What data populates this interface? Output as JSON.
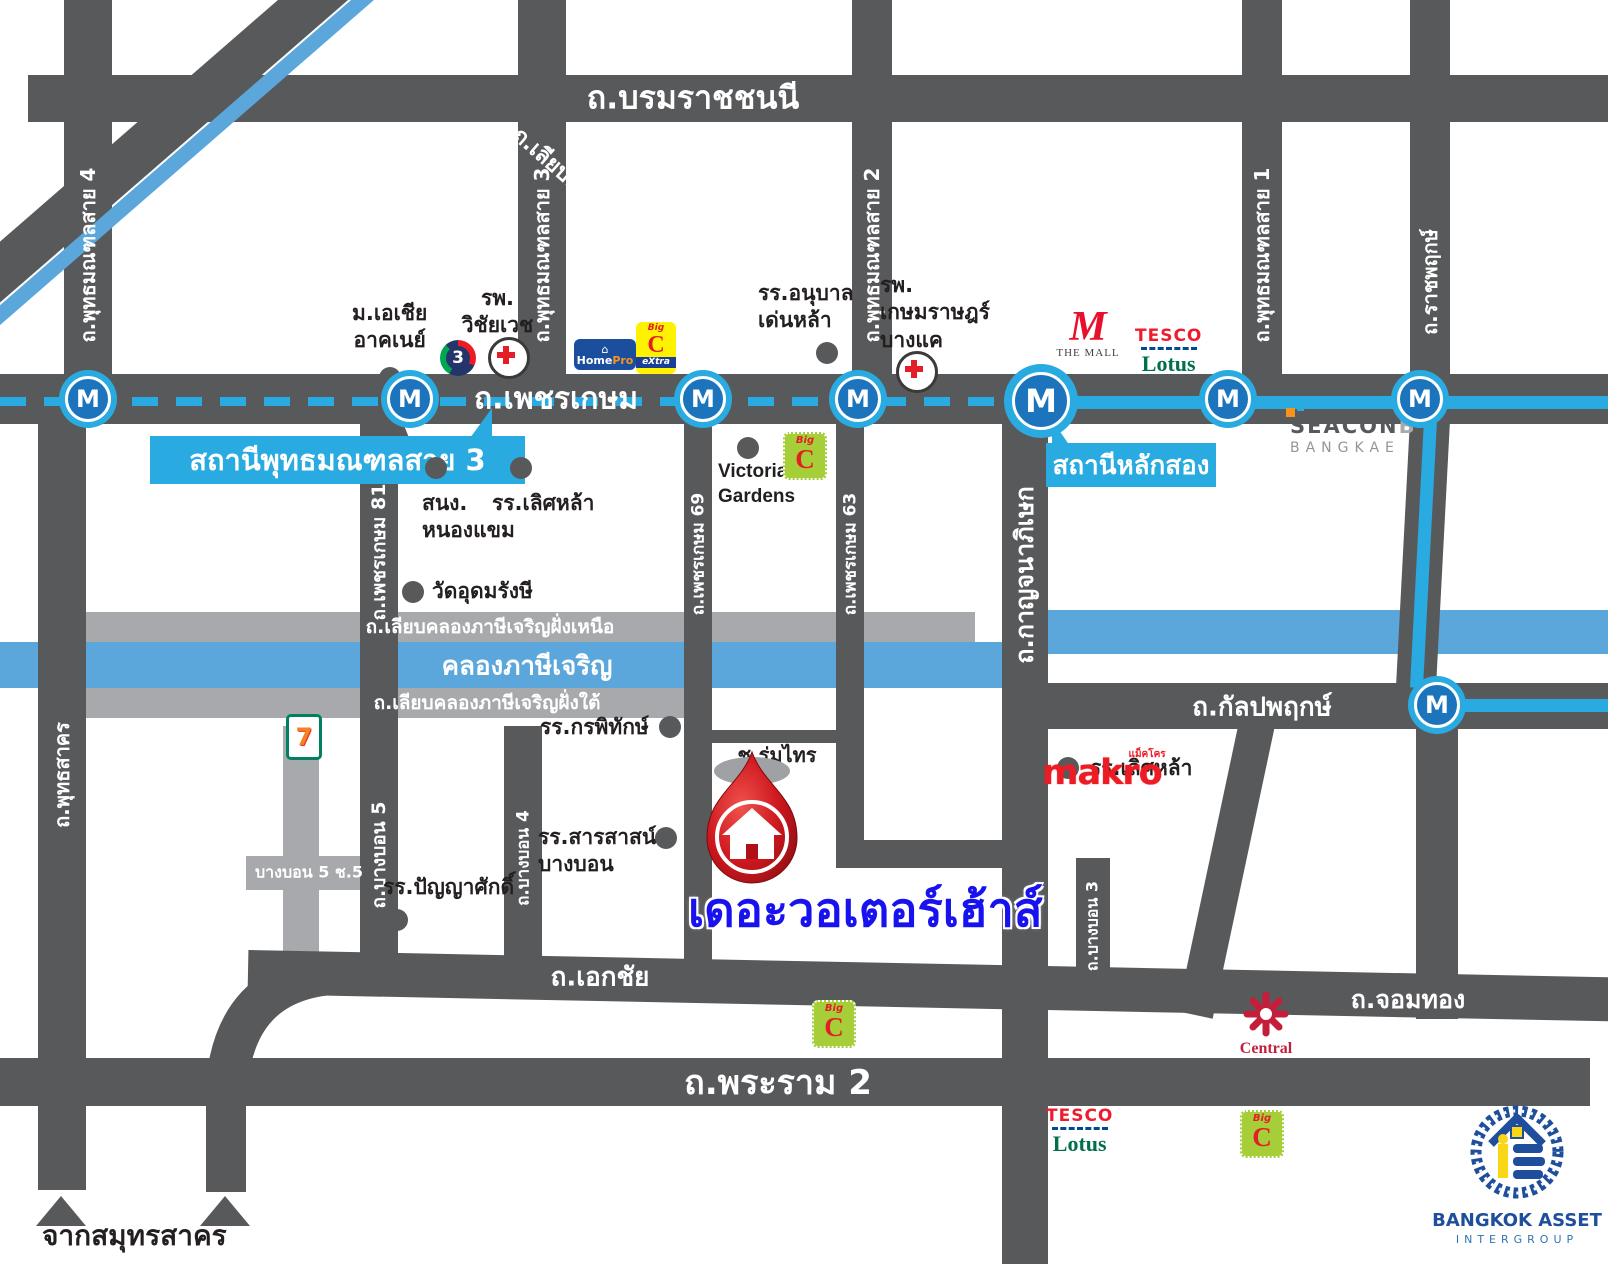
{
  "map": {
    "project": {
      "name": "เดอะวอเตอร์เฮ้าส์"
    },
    "metro": {
      "marker_letter": "M",
      "station_sai3": "สถานีพุทธมณฑลสาย 3",
      "station_lak_song": "สถานีหลักสอง",
      "line_color": "#29ABE2"
    },
    "roads": {
      "borommaratchachonnani": "ถ.บรมราชชนนี",
      "phutthamonthon_sai4": "ถ.พุทธมณฑลสาย 4",
      "phutthamonthon_sai3": "ถ.พุทธมณฑลสาย 3",
      "phutthamonthon_sai2": "ถ.พุทธมณฑลสาย 2",
      "phutthamonthon_sai1": "ถ.พุทธมณฑลสาย 1",
      "ratchaphruek": "ถ.ราชพฤกษ์",
      "liap_khlong_thawi_watthana": "ถ.เลียบคลองทวีวัฒนา",
      "phetkasem": "ถ.เพชรเกษม",
      "phetkasem81": "ถ.เพชรเกษม 81",
      "phetkasem69": "ถ.เพชรเกษม 69",
      "phetkasem63": "ถ.เพชรเกษม 63",
      "kanchanaphisek": "ถ.กาญจนาภิเษก",
      "liap_khlong_north": "ถ.เลียบคลองภาษีเจริญฝั่งเหนือ",
      "khlong_phasi_charoen": "คลองภาษีเจริญ",
      "liap_khlong_south": "ถ.เลียบคลองภาษีเจริญฝั่งใต้",
      "kanlapaphruek": "ถ.กัลปพฤกษ์",
      "phutthasakhon": "ถ.พุทธสาคร",
      "bang_bon5": "ถ.บางบอน 5",
      "bang_bon4": "ถ.บางบอน 4",
      "bang_bon3": "ถ.บางบอน 3",
      "bang_bon1": "ถ.บางบอน 1",
      "bang_bon5_soi5": "บางบอน 5 ช.5",
      "soi_rom_sai": "ช.ร่มไทร",
      "ekkachai": "ถ.เอกชัย",
      "chom_thong": "ถ.จอมทอง",
      "rama2": "ถ.พระราม 2",
      "from_samut_sakhon": "จากสมุทรสาคร"
    },
    "pois": {
      "asia_university": {
        "line1": "ม.เอเชีย",
        "line2": "อาคเนย์"
      },
      "wichaivej_hospital": {
        "line1": "รพ.",
        "line2": "วิชัยเวช"
      },
      "denla_kindergarten": {
        "line1": "รร.อนุบาล",
        "line2": "เด่นหล้า"
      },
      "kasemrad_hospital": {
        "line1": "รพ.",
        "line2": "เกษมราษฎร์",
        "line3": "บางแค"
      },
      "nong_khaem_office": {
        "line1": "สนง.",
        "line2": "หนองแขม"
      },
      "lertlah_school_phetkasem": {
        "line1": "รร.เลิศหล้า"
      },
      "wat_udom_rangsi": {
        "line1": "วัดอุดมรังษี"
      },
      "victoria_gardens": {
        "line1": "Victoria",
        "line2": "Gardens"
      },
      "kornpitak_school": {
        "line1": "รร.กรพิทักษ์"
      },
      "sarasas_school": {
        "line1": "รร.สารสาสน์",
        "line2": "บางบอน"
      },
      "panyasak_school": {
        "line1": "รร.ปัญญาศักดิ์"
      },
      "lertlah_school_kanlapaphruek": {
        "line1": "รร.เลิศหล้า"
      }
    },
    "logos": {
      "channel3": "3",
      "homepro": {
        "home": "Home",
        "pro": "Pro"
      },
      "bigc": {
        "big": "Big",
        "c": "C",
        "extra": "eXtra"
      },
      "the_mall": {
        "m": "M",
        "text": "THE MALL"
      },
      "tesco": {
        "tesco": "TESCO",
        "lotus": "Lotus"
      },
      "seacon": {
        "seacon": "SEACON",
        "b": "B",
        "bangkae": "BANGKAE"
      },
      "seven_eleven": "7",
      "makro": {
        "latin": "makro",
        "thai": "แม็คโคร"
      },
      "central": "Central",
      "bangkok_asset": {
        "line1": "BANGKOK ASSET",
        "line2": "INTERGROUP"
      }
    },
    "colors": {
      "road_dark": "#58595B",
      "road_light": "#A7A9AC",
      "canal": "#5BA7DB",
      "metro_cyan": "#29ABE2",
      "metro_inner": "#1C75BC",
      "pin_red": "#CE181E",
      "project_blue": "#1812EE"
    }
  }
}
